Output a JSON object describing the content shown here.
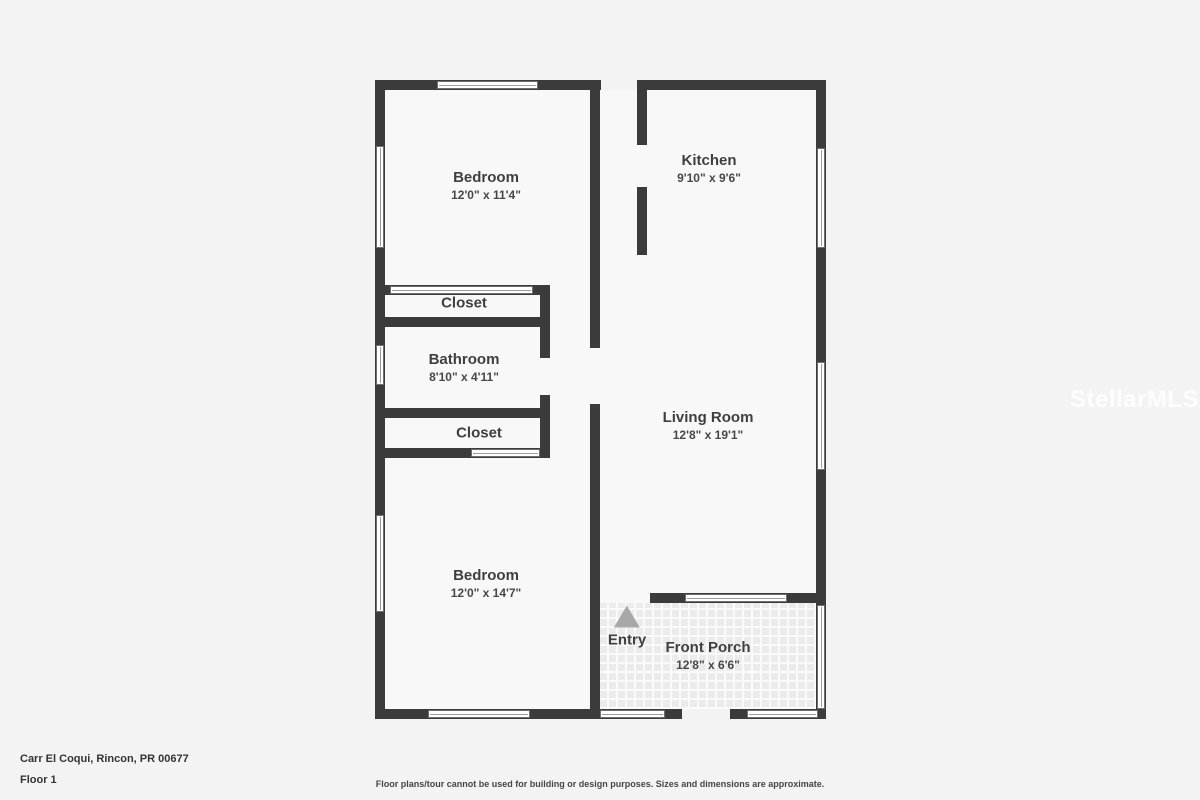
{
  "floorplan": {
    "rooms": [
      {
        "id": "bedroom-1",
        "name": "Bedroom",
        "dimensions": "12'0\" x 11'4\""
      },
      {
        "id": "kitchen",
        "name": "Kitchen",
        "dimensions": "9'10\" x 9'6\""
      },
      {
        "id": "closet-1",
        "name": "Closet",
        "dimensions": ""
      },
      {
        "id": "bathroom",
        "name": "Bathroom",
        "dimensions": "8'10\" x 4'11\""
      },
      {
        "id": "closet-2",
        "name": "Closet",
        "dimensions": ""
      },
      {
        "id": "living-room",
        "name": "Living Room",
        "dimensions": "12'8\" x 19'1\""
      },
      {
        "id": "bedroom-2",
        "name": "Bedroom",
        "dimensions": "12'0\" x 14'7\""
      },
      {
        "id": "front-porch",
        "name": "Front Porch",
        "dimensions": "12'8\" x 6'6\""
      }
    ],
    "entry_label": "Entry"
  },
  "footer": {
    "address": "Carr El Coqui, Rincon, PR 00677",
    "floor": "Floor 1",
    "disclaimer": "Floor plans/tour cannot be used for building or design purposes. Sizes and dimensions are approximate."
  },
  "watermark": "StellarMLS",
  "colors": {
    "background": "#f4f3f3",
    "room_fill": "#f8f8f8",
    "wall": "#3b3b3b",
    "label_text": "#3f3f3f",
    "entry_arrow": "#a8a8a8"
  }
}
